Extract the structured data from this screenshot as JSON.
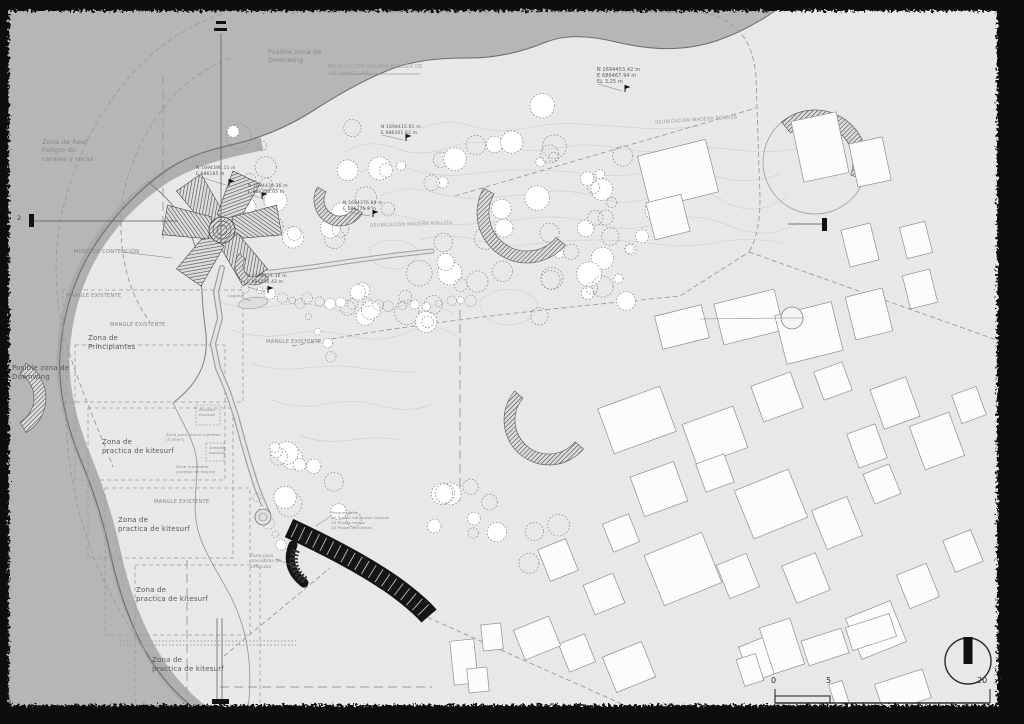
{
  "drawing": {
    "type": "architectural-site-plan",
    "scale_bar": {
      "t0": "0",
      "t1": "5",
      "t2": "20"
    },
    "section": {
      "label": "2"
    }
  },
  "colors": {
    "sea": "#b6b6b6",
    "land": "#e8e8e8",
    "beach": "#a8a8a8",
    "coast": "#6e6e6e",
    "border": "#111111",
    "building_fill": "#fcfcfc",
    "building_stroke": "#8f8f8f",
    "contour": "#d2d2d2",
    "dash": "#9a9a9a",
    "structure": "#151515",
    "g1": "#575757",
    "g2": "#878787",
    "g3": "#9d9d9d"
  },
  "labels": [
    {
      "text": "Posible zona de\nDownwing",
      "x": 268,
      "y": 48,
      "fs": 6.5,
      "c": "g2"
    },
    {
      "text": "REUBICACIÓN MADERA ROLLIZA DE\nVÍA VEHICULAR",
      "x": 375,
      "y": 64,
      "fs": 5,
      "c": "g3",
      "align": "center"
    },
    {
      "text": "N 1694453.42 m\nE 686467.94 m\nEL 3.25 m",
      "x": 597,
      "y": 68,
      "fs": 4.8,
      "c": "g1"
    },
    {
      "text": "REUBICACIÓN MADERA ROLLIZA",
      "x": 655,
      "y": 121,
      "fs": 4.8,
      "c": "g3",
      "rot": -4
    },
    {
      "text": "Zona de Reef\nPeligro de\ncorales y rocas",
      "x": 42,
      "y": 138,
      "fs": 6.5,
      "c": "g2"
    },
    {
      "text": "N 1694396.11 m\nE 686185 m",
      "x": 196,
      "y": 166,
      "fs": 4.4,
      "c": "g1"
    },
    {
      "text": "N 1694430.36 m\nE 686204.65 m",
      "x": 248,
      "y": 184,
      "fs": 4.4,
      "c": "g1"
    },
    {
      "text": "N 1694415.61 m\nE 686301.62 m",
      "x": 381,
      "y": 125,
      "fs": 4.4,
      "c": "g1"
    },
    {
      "text": "N 1694376.89 m\nE 686276.9 m",
      "x": 343,
      "y": 201,
      "fs": 4.4,
      "c": "g1"
    },
    {
      "text": "REUBICACIÓN MADERA ROLLIZA",
      "x": 370,
      "y": 224,
      "fs": 4.8,
      "c": "g3",
      "rot": -2
    },
    {
      "text": "MURO DE CONTENCIÓN",
      "x": 74,
      "y": 249,
      "fs": 5.2,
      "c": "g2"
    },
    {
      "text": "MANGLE EXISTENTE",
      "x": 66,
      "y": 293,
      "fs": 5.2,
      "c": "g2"
    },
    {
      "text": "MANGLE EXISTENTE",
      "x": 110,
      "y": 322,
      "fs": 5.2,
      "c": "g2"
    },
    {
      "text": "Zona de\nPrincipiantes",
      "x": 88,
      "y": 334,
      "fs": 7,
      "c": "g1"
    },
    {
      "text": "MANGLE EXISTENTE",
      "x": 266,
      "y": 339,
      "fs": 5.2,
      "c": "g2"
    },
    {
      "text": "N 1694324.36 m\nE 686146.43 m",
      "x": 247,
      "y": 274,
      "fs": 4.4,
      "c": "g1"
    },
    {
      "text": "Laguna",
      "x": 228,
      "y": 294,
      "fs": 3.8,
      "c": "g2"
    },
    {
      "text": "Posible zona de\nDownwing",
      "x": 12,
      "y": 364,
      "fs": 7,
      "c": "g1"
    },
    {
      "text": "Zona de\npractica de kitesurf",
      "x": 102,
      "y": 438,
      "fs": 7,
      "c": "g1"
    },
    {
      "text": "Armado\nequipos",
      "x": 199,
      "y": 408,
      "fs": 3.8,
      "c": "g2"
    },
    {
      "text": "Zona para elevar cometas\n(3.05m²)",
      "x": 166,
      "y": 433,
      "fs": 3.8,
      "c": "g2"
    },
    {
      "text": "Armado\nequipos",
      "x": 209,
      "y": 446,
      "fs": 3.8,
      "c": "g2"
    },
    {
      "text": "Zona inundable\n(cambio de marea)",
      "x": 176,
      "y": 465,
      "fs": 3.8,
      "c": "g2"
    },
    {
      "text": "MANGLE EXISTENTE",
      "x": 154,
      "y": 499,
      "fs": 5.2,
      "c": "g2"
    },
    {
      "text": "Zona de\npractica de kitesurf",
      "x": 118,
      "y": 516,
      "fs": 7,
      "c": "g1"
    },
    {
      "text": "Zona para\nmaniobras de\nvehículos",
      "x": 250,
      "y": 553,
      "fs": 4.2,
      "c": "g2"
    },
    {
      "text": "Parqueadero\n20 Plazas vehículos livianos\n16 Plazas motos\n24 Plazas bicicletas",
      "x": 331,
      "y": 511,
      "fs": 3.8,
      "c": "g2"
    },
    {
      "text": "Zona de\npractica de kitesurf",
      "x": 136,
      "y": 586,
      "fs": 7,
      "c": "g1"
    },
    {
      "text": "Zona de\npractica de kitesurf",
      "x": 152,
      "y": 656,
      "fs": 7,
      "c": "g1"
    }
  ],
  "geometry": {
    "sea": "M 0,0 L 790,0 C 772,14 748,30 716,41 C 682,52 650,50 616,42 C 592,36 566,34 546,42 C 522,52 498,58 470,58 C 440,58 417,60 394,68 C 367,78 339,94 311,112 C 284,129 254,140 227,146 C 204,151 184,158 167,170 C 133,194 104,226 85,262 C 70,291 62,322 60,355 C 58,390 66,424 80,458 C 93,489 103,520 110,552 C 117,585 128,618 143,647 C 158,675 180,700 205,716 C 220,724 238,724 252,724 L 0,724 Z",
    "coast": "M 790,0 C 772,14 748,30 716,41 C 682,52 650,50 616,42 C 592,36 566,34 546,42 C 522,52 498,58 470,58 C 440,58 417,60 394,68 C 367,78 339,94 311,112 C 284,129 254,140 227,146 C 204,151 184,158 167,170 C 133,194 104,226 85,262 C 70,291 62,322 60,355 C 58,390 66,424 80,458 C 93,489 103,520 110,552 C 117,585 128,618 143,647 C 158,675 180,700 205,716 C 220,724 238,724 252,724",
    "beach": "M 262,144 C 230,150 196,158 166,176 C 132,198 104,228 86,264 C 72,292 65,322 63,354 C 62,388 70,422 84,456 C 97,488 107,519 114,551 C 121,584 132,616 147,645 C 162,673 182,696 204,713",
    "muro": "M 148,182 C 172,200 189,224 197,252 C 203,276 201,300 205,326 C 209,352 206,378 173,403",
    "tidal": "M 173,403 C 186,430 198,446 197,470 C 196,494 192,514 200,537 C 208,559 220,576 231,597 C 241,617 247,639 249,661 C 251,683 249,705 246,722",
    "contours": [
      "M 345,152 q 25,-14 50,-4 t 52,0 t 55,-2 t 56,2 t 58,0 t 60,2 t 62,0 t 64,-2",
      "M 360,172 q 28,-10 54,-2 t 56,4 t 58,-4 t 60,4 t 62,-2 t 64,4 t 66,-2",
      "M 380,196 q 26,-12 52,-4 t 54,6 t 56,-6 t 58,6 t 60,-4 t 62,6 t 66,-4",
      "M 352,218 q 30,-8 58,0 t 60,6 t 62,-6 t 64,6 t 66,-2 t 68,4 t 70,-4",
      "M 420,240 q 28,-8 56,0 t 58,4 t 60,-4 t 62,4 t 64,-2 t 66,2",
      "M 420,128 q 26,-10 52,-2 t 54,2 t 56,-4 t 58,4 t 60,-2",
      "M 214,300 q 30,12 60,6 t 62,4 t 60,-2 t 58,6",
      "M 232,330 q 28,10 58,4 t 60,2 t 58,-4 t 52,6",
      "M 252,364 q 26,8 54,4 t 56,0 t 52,4",
      "M 272,400 q 26,10 54,4 t 56,2 t 50,-2",
      "M 300,436 q 24,8 50,4 t 52,0",
      "M 480,300 q 20,-16 44,-8 q 20,8 10,22 q -12,14 -34,10 q -22,-6 -20,-24 z",
      "M 370,248 q 16,-12 36,-6 q 18,6 8,18 q -10,12 -28,8 q -18,-4 -16,-20 z"
    ],
    "dashes": [
      {
        "d": "M 237,12 L 700,12 C 736,18 753,40 756,76 L 760,198 C 760,224 756,240 749,252",
        "s": "d"
      },
      {
        "d": "M 749,252 L 1008,344",
        "s": "d"
      },
      {
        "d": "M 455,196 L 756,108",
        "s": "d"
      },
      {
        "d": "M 222,14 C 138,42 84,122 62,212 C 52,258 55,308 69,352 C 82,394 100,432 113,467",
        "s": "d"
      },
      {
        "d": "M 230,58 C 172,80 136,136 123,196 C 116,246 127,292 150,322",
        "s": "d"
      },
      {
        "d": "M 69,352 C 60,420 70,500 95,560 C 110,598 135,640 165,676",
        "s": "d"
      },
      {
        "d": "M 292,346 C 430,320 560,308 680,296 L 749,252",
        "s": "d"
      },
      {
        "d": "M 460,296 L 460,504",
        "s": "l"
      },
      {
        "d": "M 163,76 L 163,244",
        "s": "l"
      },
      {
        "d": "M 187,560 L 187,712",
        "s": "l"
      },
      {
        "d": "M 220,687 L 432,687",
        "s": "l"
      },
      {
        "d": "M 120,641 L 296,641",
        "s": "o"
      },
      {
        "d": "M 120,645 L 296,645",
        "s": "o"
      },
      {
        "d": "M 224,656 L 330,568",
        "s": "d"
      },
      {
        "d": "M 420,614 L 640,712",
        "s": "d"
      }
    ],
    "dashed_rects": [
      [
        63,
        290,
        180,
        112
      ],
      [
        75,
        345,
        150,
        135
      ],
      [
        88,
        408,
        145,
        150
      ],
      [
        105,
        488,
        145,
        147
      ],
      [
        135,
        565,
        125,
        147
      ]
    ],
    "small_dashed_boxes": [
      [
        196,
        405,
        24,
        20
      ],
      [
        206,
        443,
        18,
        18
      ]
    ],
    "roads": {
      "main": [
        [
          222,
          268
        ],
        [
          216,
          292
        ],
        [
          220,
          318
        ],
        [
          213,
          344
        ],
        [
          218,
          368
        ],
        [
          228,
          392
        ],
        [
          236,
          416
        ],
        [
          243,
          442
        ],
        [
          250,
          466
        ],
        [
          257,
          488
        ],
        [
          263,
          503
        ],
        [
          268,
          514
        ]
      ],
      "east": [
        [
          238,
          272
        ],
        [
          272,
          272
        ],
        [
          312,
          267
        ],
        [
          352,
          261
        ],
        [
          396,
          255
        ],
        [
          432,
          251
        ]
      ]
    },
    "star": {
      "cx": 222,
      "cy": 230,
      "angles": [
        -35,
        25,
        80,
        145,
        215,
        280
      ]
    },
    "crescents": [
      [
        340,
        200,
        26,
        150,
        330,
        10
      ],
      [
        527,
        213,
        50,
        150,
        320,
        12
      ],
      [
        815,
        162,
        52,
        -20,
        130,
        14
      ],
      [
        549,
        420,
        45,
        140,
        320,
        11
      ],
      [
        6,
        398,
        40,
        -60,
        60,
        12
      ],
      [
        254,
        266,
        19,
        140,
        320,
        8
      ]
    ],
    "big_circle": [
      815,
      162,
      52
    ],
    "lagoon": [
      253,
      303,
      15,
      5.5
    ],
    "plaza": [
      263,
      517,
      8
    ],
    "parking": {
      "bar": "M 289,528 C 330,547 368,567 397,588 C 413,600 423,609 429,616",
      "hook": "M 293,545 C 287,560 291,573 304,583",
      "stripe": "M 296,550 C 291,562 295,573 306,581"
    },
    "buildings": [
      [
        797,
        116,
        46,
        62,
        -12
      ],
      [
        853,
        140,
        34,
        44,
        -12
      ],
      [
        643,
        147,
        70,
        54,
        -14
      ],
      [
        650,
        198,
        36,
        38,
        -14
      ],
      [
        845,
        226,
        30,
        38,
        -14
      ],
      [
        903,
        224,
        26,
        32,
        -14
      ],
      [
        718,
        296,
        62,
        42,
        -14
      ],
      [
        780,
        308,
        58,
        50,
        -14
      ],
      [
        850,
        292,
        38,
        44,
        -14
      ],
      [
        906,
        272,
        28,
        34,
        -14
      ],
      [
        658,
        310,
        48,
        34,
        -14
      ],
      [
        604,
        396,
        66,
        48,
        -20
      ],
      [
        688,
        414,
        54,
        44,
        -20
      ],
      [
        756,
        378,
        42,
        38,
        -20
      ],
      [
        818,
        366,
        30,
        30,
        -20
      ],
      [
        876,
        382,
        38,
        42,
        -20
      ],
      [
        916,
        418,
        42,
        46,
        -20
      ],
      [
        852,
        428,
        30,
        36,
        -20
      ],
      [
        956,
        390,
        26,
        30,
        -20
      ],
      [
        636,
        468,
        46,
        42,
        -20
      ],
      [
        700,
        458,
        30,
        30,
        -20
      ],
      [
        742,
        478,
        58,
        52,
        -22
      ],
      [
        818,
        502,
        38,
        42,
        -22
      ],
      [
        868,
        468,
        28,
        32,
        -22
      ],
      [
        652,
        542,
        62,
        54,
        -22
      ],
      [
        607,
        518,
        28,
        30,
        -22
      ],
      [
        543,
        543,
        30,
        34,
        -22
      ],
      [
        588,
        578,
        32,
        32,
        -22
      ],
      [
        722,
        558,
        32,
        36,
        -22
      ],
      [
        788,
        558,
        36,
        40,
        -22
      ],
      [
        902,
        568,
        32,
        36,
        -22
      ],
      [
        948,
        534,
        30,
        34,
        -22
      ],
      [
        852,
        608,
        48,
        44,
        -22
      ],
      [
        744,
        638,
        42,
        38,
        -22
      ],
      [
        608,
        648,
        42,
        38,
        -22
      ],
      [
        563,
        638,
        28,
        30,
        -22
      ],
      [
        518,
        622,
        38,
        32,
        -22
      ],
      [
        452,
        640,
        24,
        44,
        -6
      ],
      [
        482,
        624,
        20,
        26,
        -6
      ],
      [
        468,
        668,
        20,
        24,
        -6
      ],
      [
        766,
        622,
        32,
        48,
        -18
      ],
      [
        804,
        634,
        42,
        26,
        -18
      ],
      [
        848,
        620,
        46,
        24,
        -18
      ],
      [
        878,
        676,
        50,
        30,
        -18
      ],
      [
        832,
        682,
        14,
        24,
        -18
      ],
      [
        740,
        656,
        20,
        28,
        -18
      ]
    ],
    "callout_circle": [
      792,
      318,
      11
    ],
    "tree_clusters": [
      [
        302,
        212,
        55,
        40,
        8
      ],
      [
        398,
        168,
        55,
        48,
        10
      ],
      [
        500,
        132,
        55,
        38,
        9
      ],
      [
        562,
        218,
        65,
        42,
        10
      ],
      [
        472,
        252,
        55,
        36,
        8
      ],
      [
        622,
        172,
        38,
        32,
        6
      ],
      [
        652,
        232,
        30,
        24,
        4
      ],
      [
        255,
        152,
        28,
        28,
        5
      ],
      [
        560,
        300,
        40,
        28,
        5
      ],
      [
        618,
        300,
        30,
        22,
        4
      ],
      [
        312,
        492,
        42,
        42,
        9
      ],
      [
        452,
        502,
        48,
        38,
        7
      ],
      [
        524,
        532,
        38,
        32,
        6
      ],
      [
        300,
        457,
        28,
        16,
        4
      ],
      [
        435,
        300,
        35,
        22,
        5
      ],
      [
        368,
        300,
        40,
        18,
        6
      ],
      [
        290,
        240,
        25,
        20,
        4
      ]
    ],
    "chains": [
      [
        [
          246,
          288
        ],
        [
          258,
          292
        ],
        [
          270,
          295
        ],
        [
          282,
          297
        ],
        [
          294,
          299
        ],
        [
          306,
          300
        ],
        [
          318,
          301
        ],
        [
          330,
          302
        ],
        [
          342,
          303
        ],
        [
          354,
          303
        ],
        [
          366,
          304
        ],
        [
          378,
          305
        ],
        [
          390,
          306
        ],
        [
          402,
          306
        ],
        [
          414,
          306
        ],
        [
          426,
          305
        ],
        [
          438,
          303
        ],
        [
          450,
          301
        ],
        [
          462,
          300
        ],
        [
          472,
          299
        ]
      ],
      [
        [
          302,
          302
        ],
        [
          310,
          316
        ],
        [
          318,
          330
        ],
        [
          326,
          344
        ],
        [
          332,
          356
        ]
      ],
      [
        [
          258,
          498
        ],
        [
          263,
          510
        ],
        [
          268,
          522
        ],
        [
          274,
          534
        ],
        [
          281,
          546
        ],
        [
          288,
          556
        ]
      ]
    ],
    "flags": [
      [
        229,
        186
      ],
      [
        262,
        199
      ],
      [
        406,
        141
      ],
      [
        373,
        217
      ],
      [
        625,
        92
      ],
      [
        268,
        293
      ]
    ],
    "leaders": [
      [
        197,
        176,
        226,
        185
      ],
      [
        250,
        194,
        260,
        198
      ],
      [
        382,
        135,
        403,
        140
      ],
      [
        344,
        211,
        370,
        216
      ],
      [
        598,
        84,
        622,
        91
      ],
      [
        248,
        287,
        265,
        292
      ],
      [
        122,
        252,
        172,
        258
      ],
      [
        276,
        559,
        298,
        568
      ],
      [
        331,
        516,
        316,
        526
      ],
      [
        242,
        297,
        251,
        301
      ],
      [
        332,
        74,
        420,
        74
      ]
    ],
    "section_marks": {
      "top_line": "M 221,33 L 221,243",
      "bottom_lines": [
        "M 217,618 L 217,700",
        "M 222,618 L 222,700"
      ],
      "left_line": "M 34,221 L 178,221",
      "right_line": "M 788,224 L 822,224"
    },
    "scale_bar": {
      "x0": 775,
      "x5": 830,
      "x20": 990,
      "y": 703
    },
    "north": {
      "cx": 968,
      "cy": 661,
      "r": 23
    }
  }
}
